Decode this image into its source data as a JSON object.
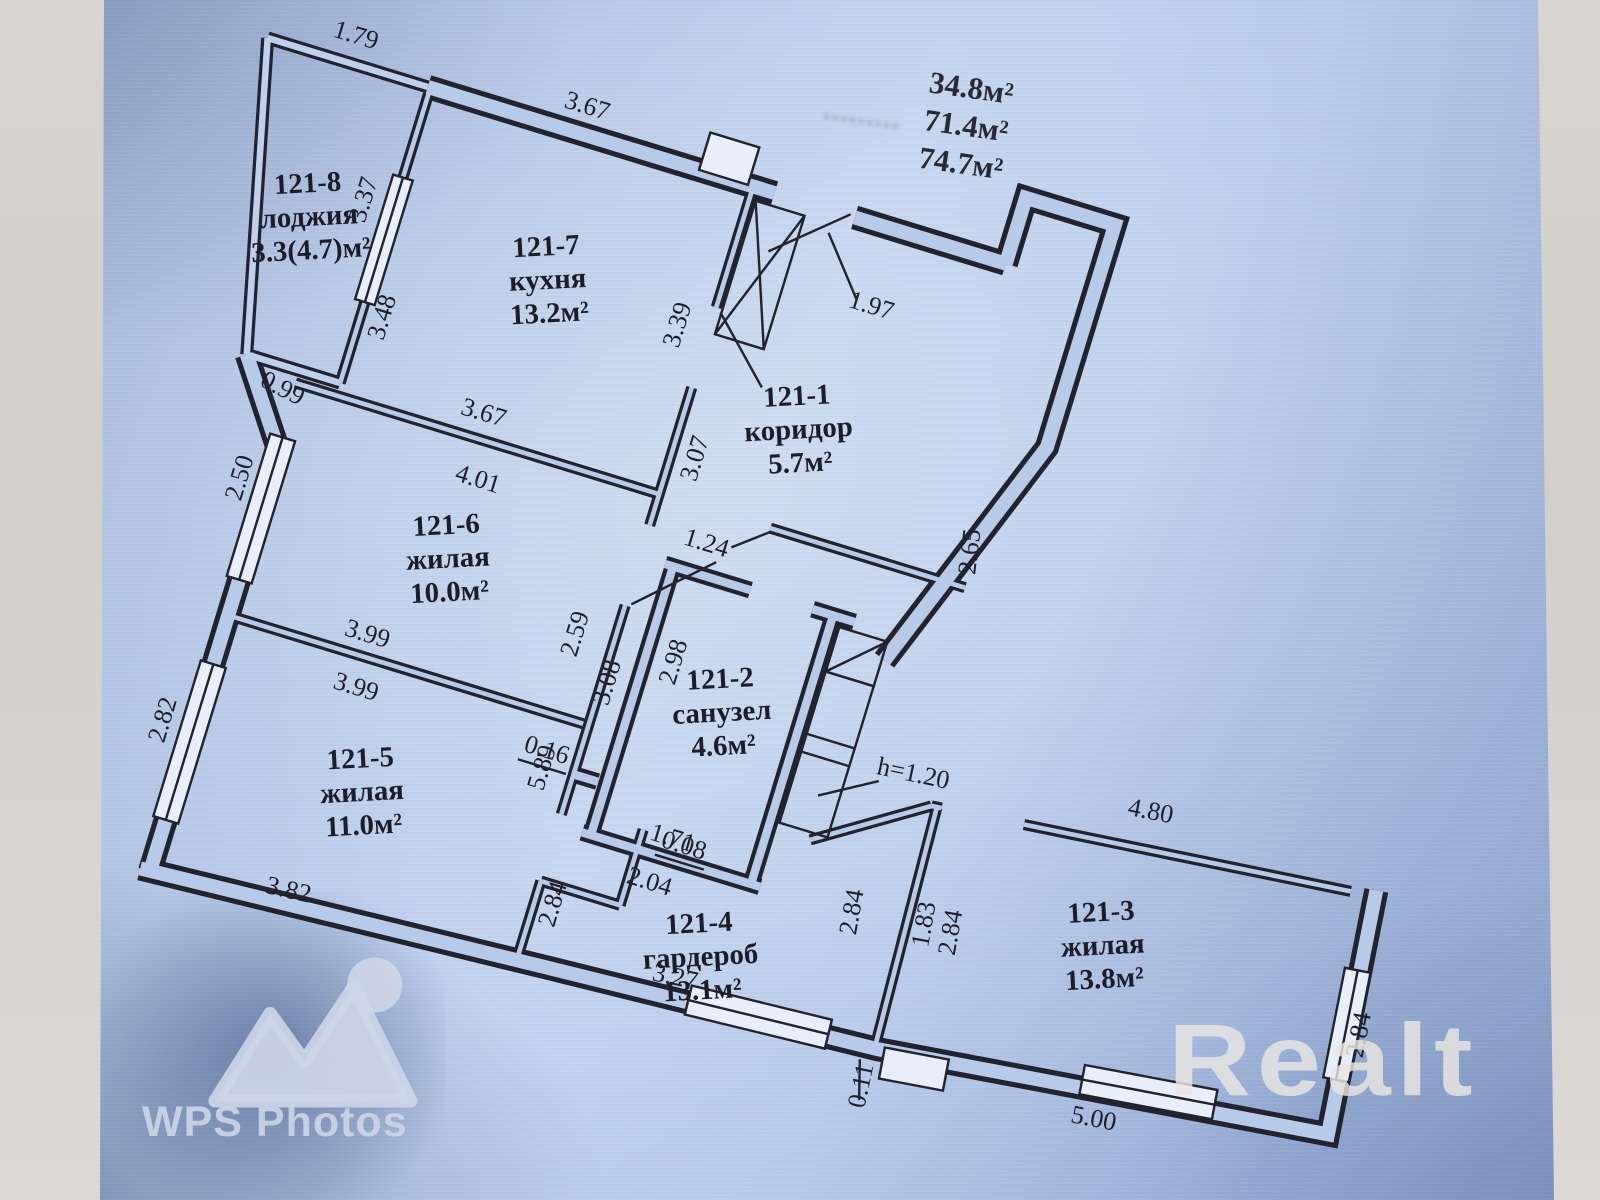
{
  "photo": {
    "areas": {
      "living_total": "34.8м²",
      "total": "71.4м²",
      "total_with_balcony": "74.7м²",
      "ghost": "………"
    },
    "watermark": {
      "brand": "WPS Photos"
    },
    "agency_logo": "Realt"
  },
  "rooms": {
    "r8": {
      "id": "121-8",
      "name": "лоджия",
      "area": "3.3(4.7)м²"
    },
    "r7": {
      "id": "121-7",
      "name": "кухня",
      "area": "13.2м²"
    },
    "r1": {
      "id": "121-1",
      "name": "коридор",
      "area": "5.7м²"
    },
    "r6": {
      "id": "121-6",
      "name": "жилая",
      "area": "10.0м²"
    },
    "r2": {
      "id": "121-2",
      "name": "санузел",
      "area": "4.6м²"
    },
    "r5": {
      "id": "121-5",
      "name": "жилая",
      "area": "11.0м²"
    },
    "r4": {
      "id": "121-4",
      "name": "гардероб",
      "area": "13.1м²"
    },
    "r3": {
      "id": "121-3",
      "name": "жилая",
      "area": "13.8м²"
    }
  },
  "dims": {
    "loggia_top": "1.79",
    "loggia_side": "3.37",
    "loggia_wall": "3.48",
    "loggia_bottom": "0.99",
    "kitchen_top": "3.67",
    "kitchen_bottom": "3.67",
    "kitchen_right_up": "3.39",
    "kitchen_right_low": "3.07",
    "entry_width": "1.97",
    "entry_side": "2.65",
    "r6_top": "4.01",
    "r6_left": "2.50",
    "r6_right": "2.59",
    "r6_bottom": "3.99",
    "r5_top": "3.99",
    "r5_left": "2.82",
    "r5_bottom": "3.82",
    "hall_wall": "5.89",
    "ward_left": "2.84",
    "ward_stub": "0.08",
    "bath_gap": "1.24",
    "bath_wall": "3.08",
    "bath_inner": "2.98",
    "bath_offset": "0.16",
    "bath_bottom": "1.71",
    "bath_below": "2.04",
    "duct_height": "h=1.20",
    "ward_right": "2.84",
    "ward_wall": "1.83",
    "ward_bottom": "3.27",
    "bottom_offset": "0.11",
    "r3_top": "4.80",
    "r3_left": "2.84",
    "r3_right": "2.84",
    "r3_bottom": "5.00"
  }
}
